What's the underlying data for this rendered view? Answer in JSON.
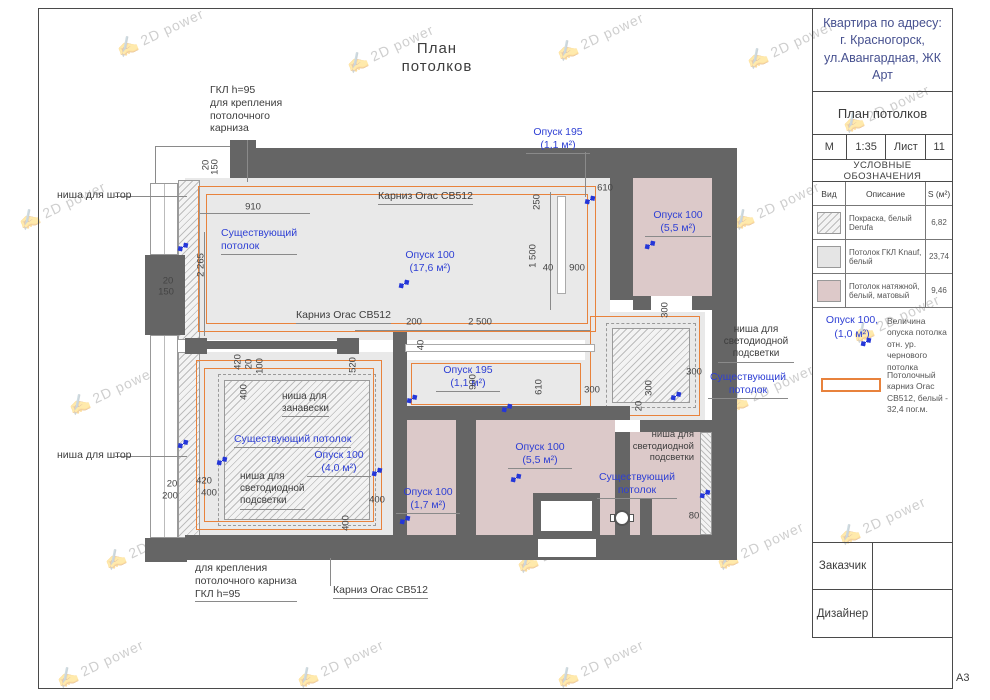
{
  "watermark": {
    "text": "2D power"
  },
  "sheet": {
    "format_label": "А3"
  },
  "drawing": {
    "title": "План потолков",
    "annotations": [
      {
        "n": "note-gkl-top",
        "t": "ГКЛ h=95\nдля крепления\nпотолочного\nкарниза",
        "x": 210,
        "y": 84,
        "c": "ink",
        "s": 10.5,
        "a": "l"
      },
      {
        "n": "note-nisha-shtor-1",
        "t": "ниша для штор",
        "x": 57,
        "y": 189,
        "c": "ink",
        "s": 10.5,
        "a": "l"
      },
      {
        "n": "note-nisha-shtor-2",
        "t": "ниша для штор",
        "x": 57,
        "y": 449,
        "c": "ink",
        "s": 10.5,
        "a": "l"
      },
      {
        "n": "label-karniz-1",
        "t": "Карниз Orac CB512",
        "x": 378,
        "y": 190,
        "c": "ink",
        "s": 10.5,
        "a": "l",
        "u": 1
      },
      {
        "n": "label-karniz-2",
        "t": "Карниз Orac CB512",
        "x": 296,
        "y": 309,
        "c": "ink",
        "s": 10.5,
        "a": "l",
        "u": 1
      },
      {
        "n": "label-karniz-3",
        "t": "Карниз Orac CB512",
        "x": 333,
        "y": 584,
        "c": "ink",
        "s": 10.5,
        "a": "l",
        "u": 1
      },
      {
        "n": "note-nisha-zanaveski",
        "t": "ниша для\nзанавески",
        "x": 282,
        "y": 391,
        "c": "ink",
        "s": 10,
        "a": "l",
        "u": 1
      },
      {
        "n": "note-led-bedroom",
        "t": "ниша для\nсветодиодной\nподсветки",
        "x": 240,
        "y": 471,
        "c": "ink",
        "s": 10,
        "a": "l",
        "u": 1
      },
      {
        "n": "note-gkl-bottom",
        "t": "для крепления\nпотолочного карниза\nГКЛ h=95",
        "x": 195,
        "y": 562,
        "c": "ink",
        "s": 10.5,
        "a": "l",
        "u": 1
      },
      {
        "n": "note-led-hallway",
        "t": "ниша для\nсветодиодной\nподсветки",
        "x": 718,
        "y": 324,
        "c": "ink",
        "s": 10,
        "a": "c",
        "w": 76,
        "u": 1
      },
      {
        "n": "note-led-right-room",
        "t": "ниша для\nсветодиодной\nподсветки",
        "x": 622,
        "y": 429,
        "c": "ink",
        "s": 9.5,
        "a": "r",
        "w": 72
      },
      {
        "n": "label-opusk195-top",
        "t": "Опуск 195\n(1,1 м²)",
        "x": 526,
        "y": 126,
        "c": "blue",
        "s": 10.5,
        "a": "c",
        "w": 64,
        "u": 1
      },
      {
        "n": "label-sush-living",
        "t": "Существующий\nпотолок",
        "x": 221,
        "y": 227,
        "c": "blue",
        "s": 10.5,
        "a": "l",
        "u": 1
      },
      {
        "n": "label-opusk100-living",
        "t": "Опуск 100\n(17,6 м²)",
        "x": 398,
        "y": 249,
        "c": "blue",
        "s": 10.5,
        "a": "c",
        "w": 64
      },
      {
        "n": "label-opusk100-kitchen",
        "t": "Опуск 100\n(5,5 м²)",
        "x": 645,
        "y": 209,
        "c": "blue",
        "s": 10.5,
        "a": "c",
        "w": 66,
        "u": 1
      },
      {
        "n": "label-opusk195-corridor",
        "t": "Опуск 195\n(1,1 м²)",
        "x": 436,
        "y": 364,
        "c": "blue",
        "s": 10.5,
        "a": "c",
        "w": 64,
        "u": 1
      },
      {
        "n": "label-sush-hallway",
        "t": "Существующий\nпотолок",
        "x": 708,
        "y": 371,
        "c": "blue",
        "s": 10.5,
        "a": "c",
        "w": 80,
        "u": 1
      },
      {
        "n": "label-sush-bedroom",
        "t": "Существующий потолок",
        "x": 234,
        "y": 433,
        "c": "blue",
        "s": 10.5,
        "a": "l",
        "u": 1
      },
      {
        "n": "label-opusk100-bedroom",
        "t": "Опуск 100\n(4,0 м²)",
        "x": 307,
        "y": 449,
        "c": "blue",
        "s": 10.5,
        "a": "c",
        "w": 64,
        "u": 1
      },
      {
        "n": "label-opusk100-bath",
        "t": "Опуск 100\n(5,5 м²)",
        "x": 508,
        "y": 441,
        "c": "blue",
        "s": 10.5,
        "a": "c",
        "w": 64,
        "u": 1
      },
      {
        "n": "label-opusk100-small",
        "t": "Опуск 100\n(1,7 м²)",
        "x": 396,
        "y": 486,
        "c": "blue",
        "s": 10.5,
        "a": "c",
        "w": 64,
        "u": 1
      },
      {
        "n": "label-sush-right",
        "t": "Существующий\nпотолок",
        "x": 597,
        "y": 471,
        "c": "blue",
        "s": 10.5,
        "a": "c",
        "w": 80,
        "u": 1
      },
      {
        "n": "dim-910",
        "t": "910",
        "x": 253,
        "y": 207,
        "k": "dim"
      },
      {
        "n": "dim-610-top",
        "t": "610",
        "x": 605,
        "y": 188,
        "k": "dim"
      },
      {
        "n": "dim-40-a",
        "t": "40",
        "x": 548,
        "y": 268,
        "k": "dim"
      },
      {
        "n": "dim-900-a",
        "t": "900",
        "x": 577,
        "y": 268,
        "k": "dim"
      },
      {
        "n": "dim-200",
        "t": "200",
        "x": 414,
        "y": 322,
        "k": "dim"
      },
      {
        "n": "dim-2500",
        "t": "2 500",
        "x": 480,
        "y": 322,
        "k": "dim"
      },
      {
        "n": "dim-300-left",
        "t": "300",
        "x": 592,
        "y": 390,
        "k": "dim"
      },
      {
        "n": "dim-300-right",
        "t": "300",
        "x": 694,
        "y": 372,
        "k": "dim"
      },
      {
        "n": "dim-420-left",
        "t": "420",
        "x": 204,
        "y": 481,
        "k": "dim"
      },
      {
        "n": "dim-400-left",
        "t": "400",
        "x": 209,
        "y": 493,
        "k": "dim"
      },
      {
        "n": "dim-400-right",
        "t": "400",
        "x": 377,
        "y": 500,
        "k": "dim"
      },
      {
        "n": "dim-80",
        "t": "80",
        "x": 694,
        "y": 516,
        "k": "dim"
      },
      {
        "n": "dim-20-a",
        "t": "20",
        "x": 168,
        "y": 281,
        "k": "dim"
      },
      {
        "n": "dim-150-a",
        "t": "150",
        "x": 166,
        "y": 292,
        "k": "dim"
      },
      {
        "n": "dim-20-b",
        "t": "20",
        "x": 172,
        "y": 484,
        "k": "dim"
      },
      {
        "n": "dim-200-b",
        "t": "200",
        "x": 170,
        "y": 496,
        "k": "dim"
      },
      {
        "n": "dim-20-v",
        "t": "20",
        "x": 206,
        "y": 165,
        "k": "dim",
        "r": 1
      },
      {
        "n": "dim-150-v",
        "t": "150",
        "x": 215,
        "y": 167,
        "k": "dim",
        "r": 1
      },
      {
        "n": "dim-2265-v",
        "t": "2 265",
        "x": 201,
        "y": 265,
        "k": "dim",
        "r": 1
      },
      {
        "n": "dim-250-v",
        "t": "250",
        "x": 537,
        "y": 202,
        "k": "dim",
        "r": 1
      },
      {
        "n": "dim-1500-v",
        "t": "1 500",
        "x": 533,
        "y": 256,
        "k": "dim",
        "r": 1
      },
      {
        "n": "dim-520-v",
        "t": "520",
        "x": 353,
        "y": 365,
        "k": "dim",
        "r": 1
      },
      {
        "n": "dim-40-v",
        "t": "40",
        "x": 421,
        "y": 345,
        "k": "dim",
        "r": 1
      },
      {
        "n": "dim-900-v",
        "t": "900",
        "x": 473,
        "y": 382,
        "k": "dim",
        "r": 1
      },
      {
        "n": "dim-610-v",
        "t": "610",
        "x": 539,
        "y": 387,
        "k": "dim",
        "r": 1
      },
      {
        "n": "dim-300-v-top",
        "t": "300",
        "x": 665,
        "y": 310,
        "k": "dim",
        "r": 1
      },
      {
        "n": "dim-300-v-inner",
        "t": "300",
        "x": 649,
        "y": 388,
        "k": "dim",
        "r": 1
      },
      {
        "n": "dim-20-v-inner",
        "t": "20",
        "x": 639,
        "y": 406,
        "k": "dim",
        "r": 1
      },
      {
        "n": "dim-420-v",
        "t": "420",
        "x": 238,
        "y": 362,
        "k": "dim",
        "r": 1
      },
      {
        "n": "dim-20-v-b",
        "t": "20",
        "x": 249,
        "y": 364,
        "k": "dim",
        "r": 1
      },
      {
        "n": "dim-100-v",
        "t": "100",
        "x": 260,
        "y": 366,
        "k": "dim",
        "r": 1
      },
      {
        "n": "dim-400-v-a",
        "t": "400",
        "x": 244,
        "y": 392,
        "k": "dim",
        "r": 1
      },
      {
        "n": "dim-400-v-b",
        "t": "400",
        "x": 346,
        "y": 523,
        "k": "dim",
        "r": 1
      }
    ],
    "markers": [
      [
        404,
        284
      ],
      [
        183,
        247
      ],
      [
        183,
        444
      ],
      [
        650,
        245
      ],
      [
        590,
        200
      ],
      [
        412,
        399
      ],
      [
        222,
        461
      ],
      [
        377,
        472
      ],
      [
        516,
        478
      ],
      [
        405,
        520
      ],
      [
        507,
        408
      ],
      [
        705,
        494
      ],
      [
        676,
        396
      ],
      [
        866,
        342
      ]
    ]
  },
  "titleblock": {
    "address": "Квартира по адресу:\nг. Красногорск,\nул.Авангардная, ЖК Арт",
    "doc_title": "План потолков",
    "scale_label": "М",
    "scale_value": "1:35",
    "sheet_label": "Лист",
    "sheet_value": "11",
    "legend_title": "УСЛОВНЫЕ ОБОЗНАЧЕНИЯ",
    "table": {
      "col_type": "Вид",
      "col_desc": "Описание",
      "col_area": "S (м²)",
      "rows": [
        {
          "swatch": "hatch",
          "desc": "Покраска, белый Derufa",
          "area": "6,82"
        },
        {
          "swatch": "gray",
          "desc": "Потолок ГКЛ Knauf, белый",
          "area": "23,74"
        },
        {
          "swatch": "pink",
          "desc": "Потолок натяжной, белый, матовый",
          "area": "9,46"
        }
      ]
    },
    "symbol_opusk_label": "Опуск 100,\n(1,0 м²)",
    "symbol_opusk_desc": "Величина опуска потолка отн. ур. чернового потолка",
    "symbol_cornice_desc": "Потолочный карниз Orac CB512, белый - 32,4 пог.м.",
    "customer_label": "Заказчик",
    "designer_label": "Дизайнер"
  },
  "colors": {
    "accent_orange": "#e8823c",
    "label_blue": "#2e3fd4",
    "ink": "#3d3d3d",
    "dim": "#444444",
    "wall_gray": "#656565",
    "ceiling_gray": "#e9e9e9",
    "ceiling_pink": "#dcc9c9",
    "address_blue": "#46508f"
  }
}
